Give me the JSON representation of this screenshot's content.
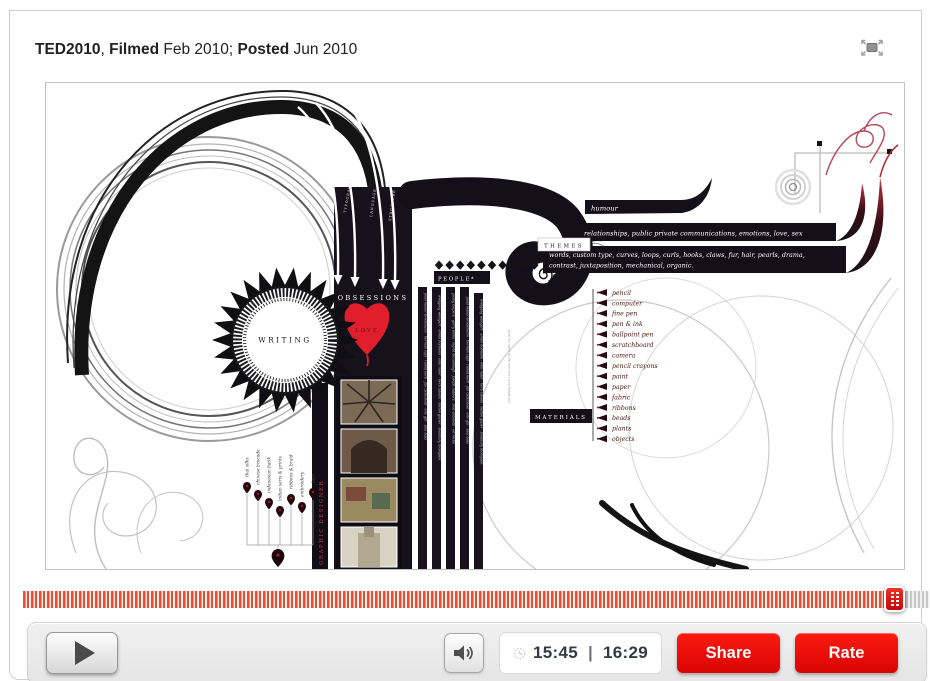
{
  "header": {
    "event": "TED2010",
    "comma": ", ",
    "filmed_label": "Filmed",
    "filmed_date": " Feb 2010; ",
    "posted_label": "Posted",
    "posted_date": " Jun 2010"
  },
  "artwork": {
    "obsessions": "OBSESSIONS",
    "love": "LOVE",
    "writing": "WRITING",
    "people": "PEOPLE*",
    "themes": "THEMES",
    "materials": "MATERIALS",
    "humour": "humour",
    "relationships": "relationships, public private communications, emotions, love, sex",
    "words_line1": "words, custom type, curves, loops, curls, hooks, claws, fur, hair, pearls, drama,",
    "words_line2": "contrast, juxtaposition, mechanical, organic.",
    "materials_list": [
      "pencil",
      "computer",
      "fine pen",
      "pen & ink",
      "ballpoint pen",
      "scratchboard",
      "camera",
      "pencil crayons",
      "paint",
      "paper",
      "fabric",
      "ribbons",
      "beads",
      "plants",
      "objects"
    ],
    "fabrics_list": [
      "thai silks",
      "chinese brocade",
      "indonesian batik",
      "indian saris & prints",
      "ribbons & braid",
      "embroidery",
      "lace"
    ],
    "designer": "GRAPHIC DESIGNER",
    "arrow_labels": [
      "CEREMONY",
      "PATTERN",
      "TYPOGRAPHY",
      "LANGUAGE",
      "STRUCTURE"
    ],
    "names_a": "josef muller-brockmann · herman zapf · rudolf koch · jan tschichold · eric gill · saul bass",
    "names_b": "wolfgang weingart · armin hofmann · emil ruder · herb lubalin · milton glaser · bradbury thompson",
    "names_c": "young helpers · gerry blims · ingrid mcvannagh · joseph radders · fred antonelli · ed roche",
    "caption": "everything here i love and use to make my work"
  },
  "scrubber": {
    "position": "94.5%"
  },
  "controls": {
    "time_current": "15:45",
    "time_separator": "|",
    "time_total": "16:29",
    "share": "Share",
    "rate": "Rate"
  },
  "colors": {
    "ted_red": "#e60b0b",
    "scrubber_red": "#e25138",
    "heart_red": "#e11f2c"
  }
}
